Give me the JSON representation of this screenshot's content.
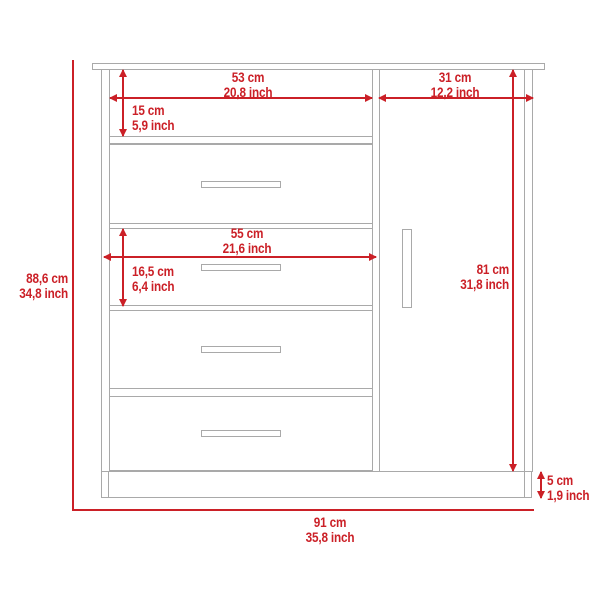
{
  "diagram": {
    "type": "furniture-dimension-diagram",
    "subject": "dresser with 4 drawers, open shelf and single door",
    "colors": {
      "dimension_red": "#cb2027",
      "furniture_gray": "#a9a9a9",
      "background": "#ffffff"
    },
    "dimensions": {
      "top_left_width": {
        "cm": "53 cm",
        "inch": "20,8 inch"
      },
      "top_right_width": {
        "cm": "31 cm",
        "inch": "12,2 inch"
      },
      "shelf_height": {
        "cm": "15 cm",
        "inch": "5,9 inch"
      },
      "drawer_width": {
        "cm": "55 cm",
        "inch": "21,6 inch"
      },
      "drawer_height": {
        "cm": "16,5 cm",
        "inch": "6,4 inch"
      },
      "overall_height": {
        "cm": "88,6 cm",
        "inch": "34,8 inch"
      },
      "door_height": {
        "cm": "81 cm",
        "inch": "31,8 inch"
      },
      "base_height": {
        "cm": "5 cm",
        "inch": "1,9 inch"
      },
      "overall_width": {
        "cm": "91 cm",
        "inch": "35,8 inch"
      }
    }
  }
}
